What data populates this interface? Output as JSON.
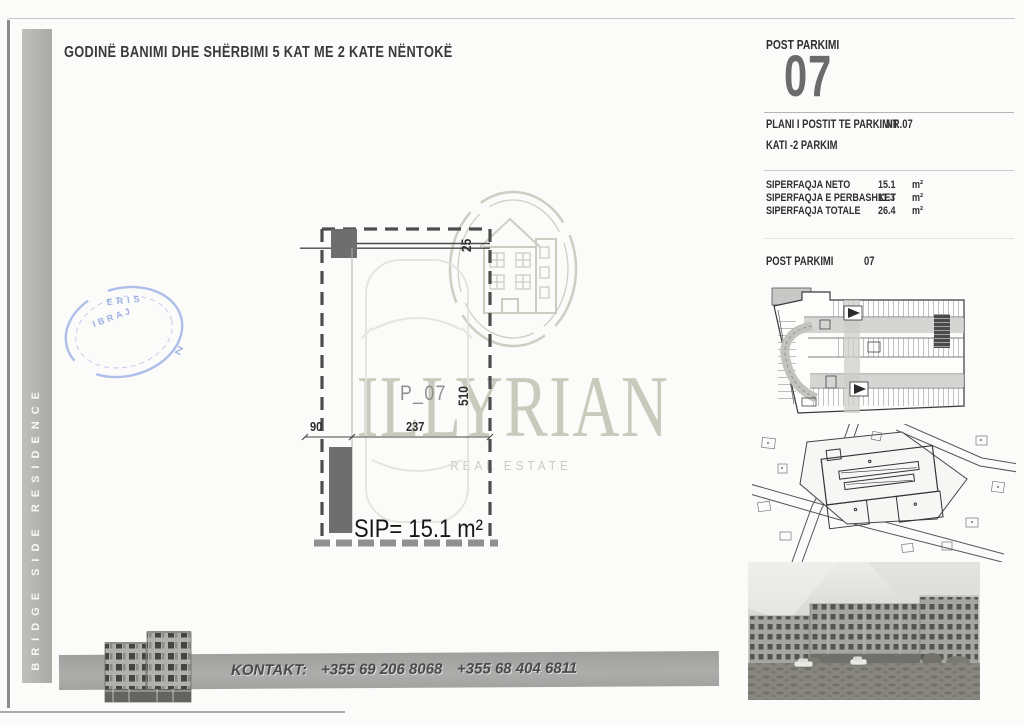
{
  "document": {
    "title": "GODINË BANIMI DHE SHËRBIMI 5 KAT ME 2 KATE NËNTOKË"
  },
  "sidebar": {
    "label": "BRIDGE SIDE RESIDENCE"
  },
  "watermark": {
    "brand": "ILLYRIAN",
    "tagline": "REAL ESTATE"
  },
  "stamp": {
    "fragments": [
      "ERIS",
      "IBRAJ",
      "Z"
    ]
  },
  "drawing": {
    "spot_label": "P_07",
    "area_text": "SIP= 15.1 m²",
    "dim_beam": "25",
    "dim_length": "510",
    "dim_wall": "90",
    "dim_width": "237"
  },
  "panel": {
    "header": "POST PARKIMI",
    "number": "07",
    "plan_row": {
      "label": "PLANI I POSTIT TE PARKIMIT",
      "nr": "NR.07"
    },
    "floor": "KATI -2 PARKIM",
    "areas": [
      {
        "label": "SIPERFAQJA NETO",
        "value": "15.1",
        "unit": "m²"
      },
      {
        "label": "SIPERFAQJA E PERBASHKET",
        "value": "11.3",
        "unit": "m²"
      },
      {
        "label": "SIPERFAQJA TOTALE",
        "value": "26.4",
        "unit": "m²"
      }
    ],
    "post_row": {
      "label": "POST PARKIMI",
      "value": "07"
    }
  },
  "footer": {
    "label": "KONTAKT:",
    "phone1": "+355 69 206 8068",
    "phone2": "+355 68 404 6811"
  }
}
